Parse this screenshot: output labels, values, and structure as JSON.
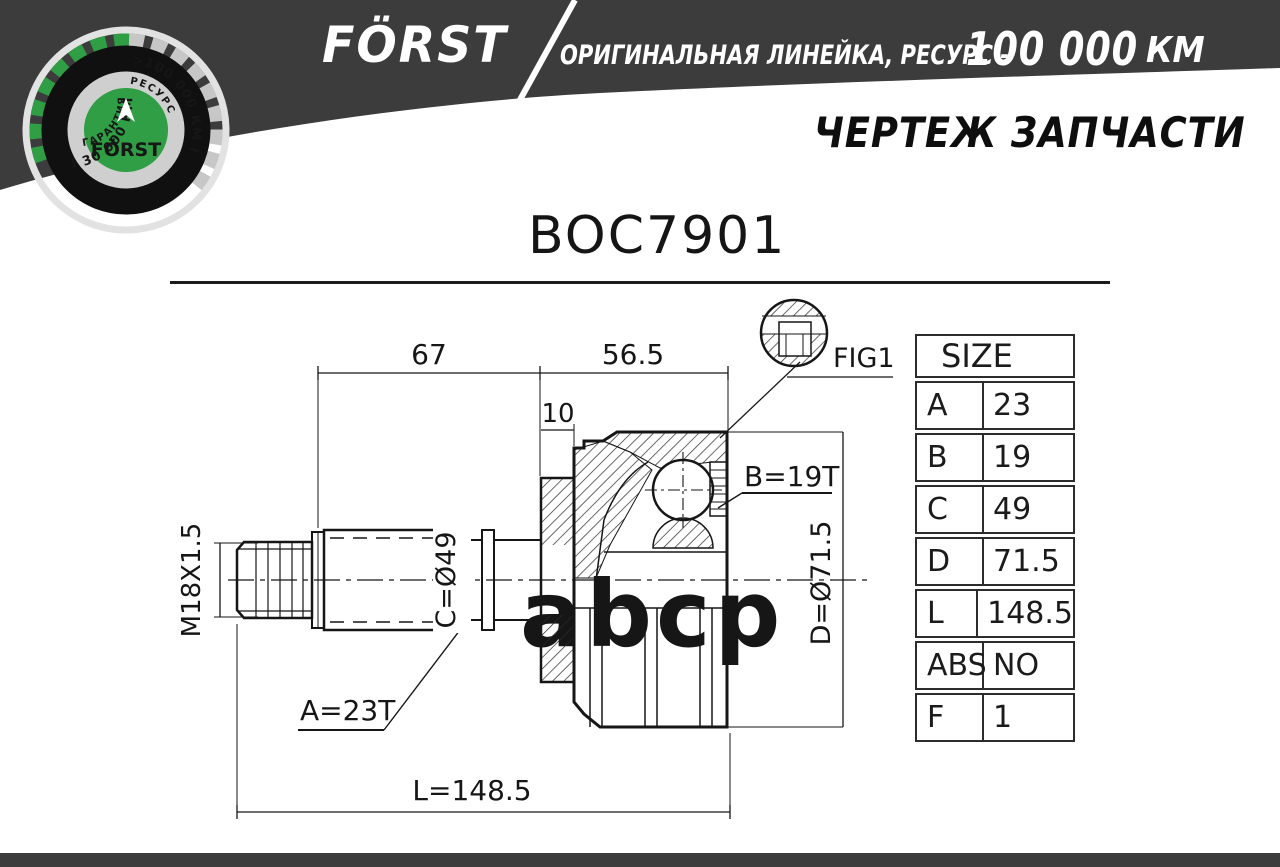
{
  "header": {
    "brand": "FÖRST",
    "tagline": "ОРИГИНАЛЬНАЯ ЛИНЕЙКА, РЕСУРС -",
    "resource_value": "100 000",
    "resource_unit": "КМ",
    "page_title": "ЧЕРТЕЖ ЗАПЧАСТИ",
    "band_color": "#3c3c3c",
    "accent_green": "#2f9e44"
  },
  "badge": {
    "arc_left": "I 30 000 КМ",
    "arc_right": ">100 000 КМ I",
    "inner_left": "ГАРАНТИЯ",
    "inner_right": "РЕСУРС",
    "center": "FÖRST"
  },
  "part": {
    "number": "BOC7901"
  },
  "drawing": {
    "dimensions": {
      "top_left": "67",
      "top_right": "56.5",
      "flange": "10",
      "thread": "M18X1.5",
      "shaft_spline": "A=23T",
      "cup_spline": "B=19T",
      "shaft_dia": "C=Ø49",
      "cup_dia": "D=Ø71.5",
      "length": "L=148.5",
      "detail_ref": "FIG1"
    }
  },
  "size_table": {
    "title": "SIZE",
    "rows": [
      [
        "A",
        "23"
      ],
      [
        "B",
        "19"
      ],
      [
        "C",
        "49"
      ],
      [
        "D",
        "71.5"
      ],
      [
        "L",
        "148.5"
      ],
      [
        "ABS",
        "NO"
      ],
      [
        "F",
        "1"
      ]
    ]
  },
  "watermark": "abcp"
}
